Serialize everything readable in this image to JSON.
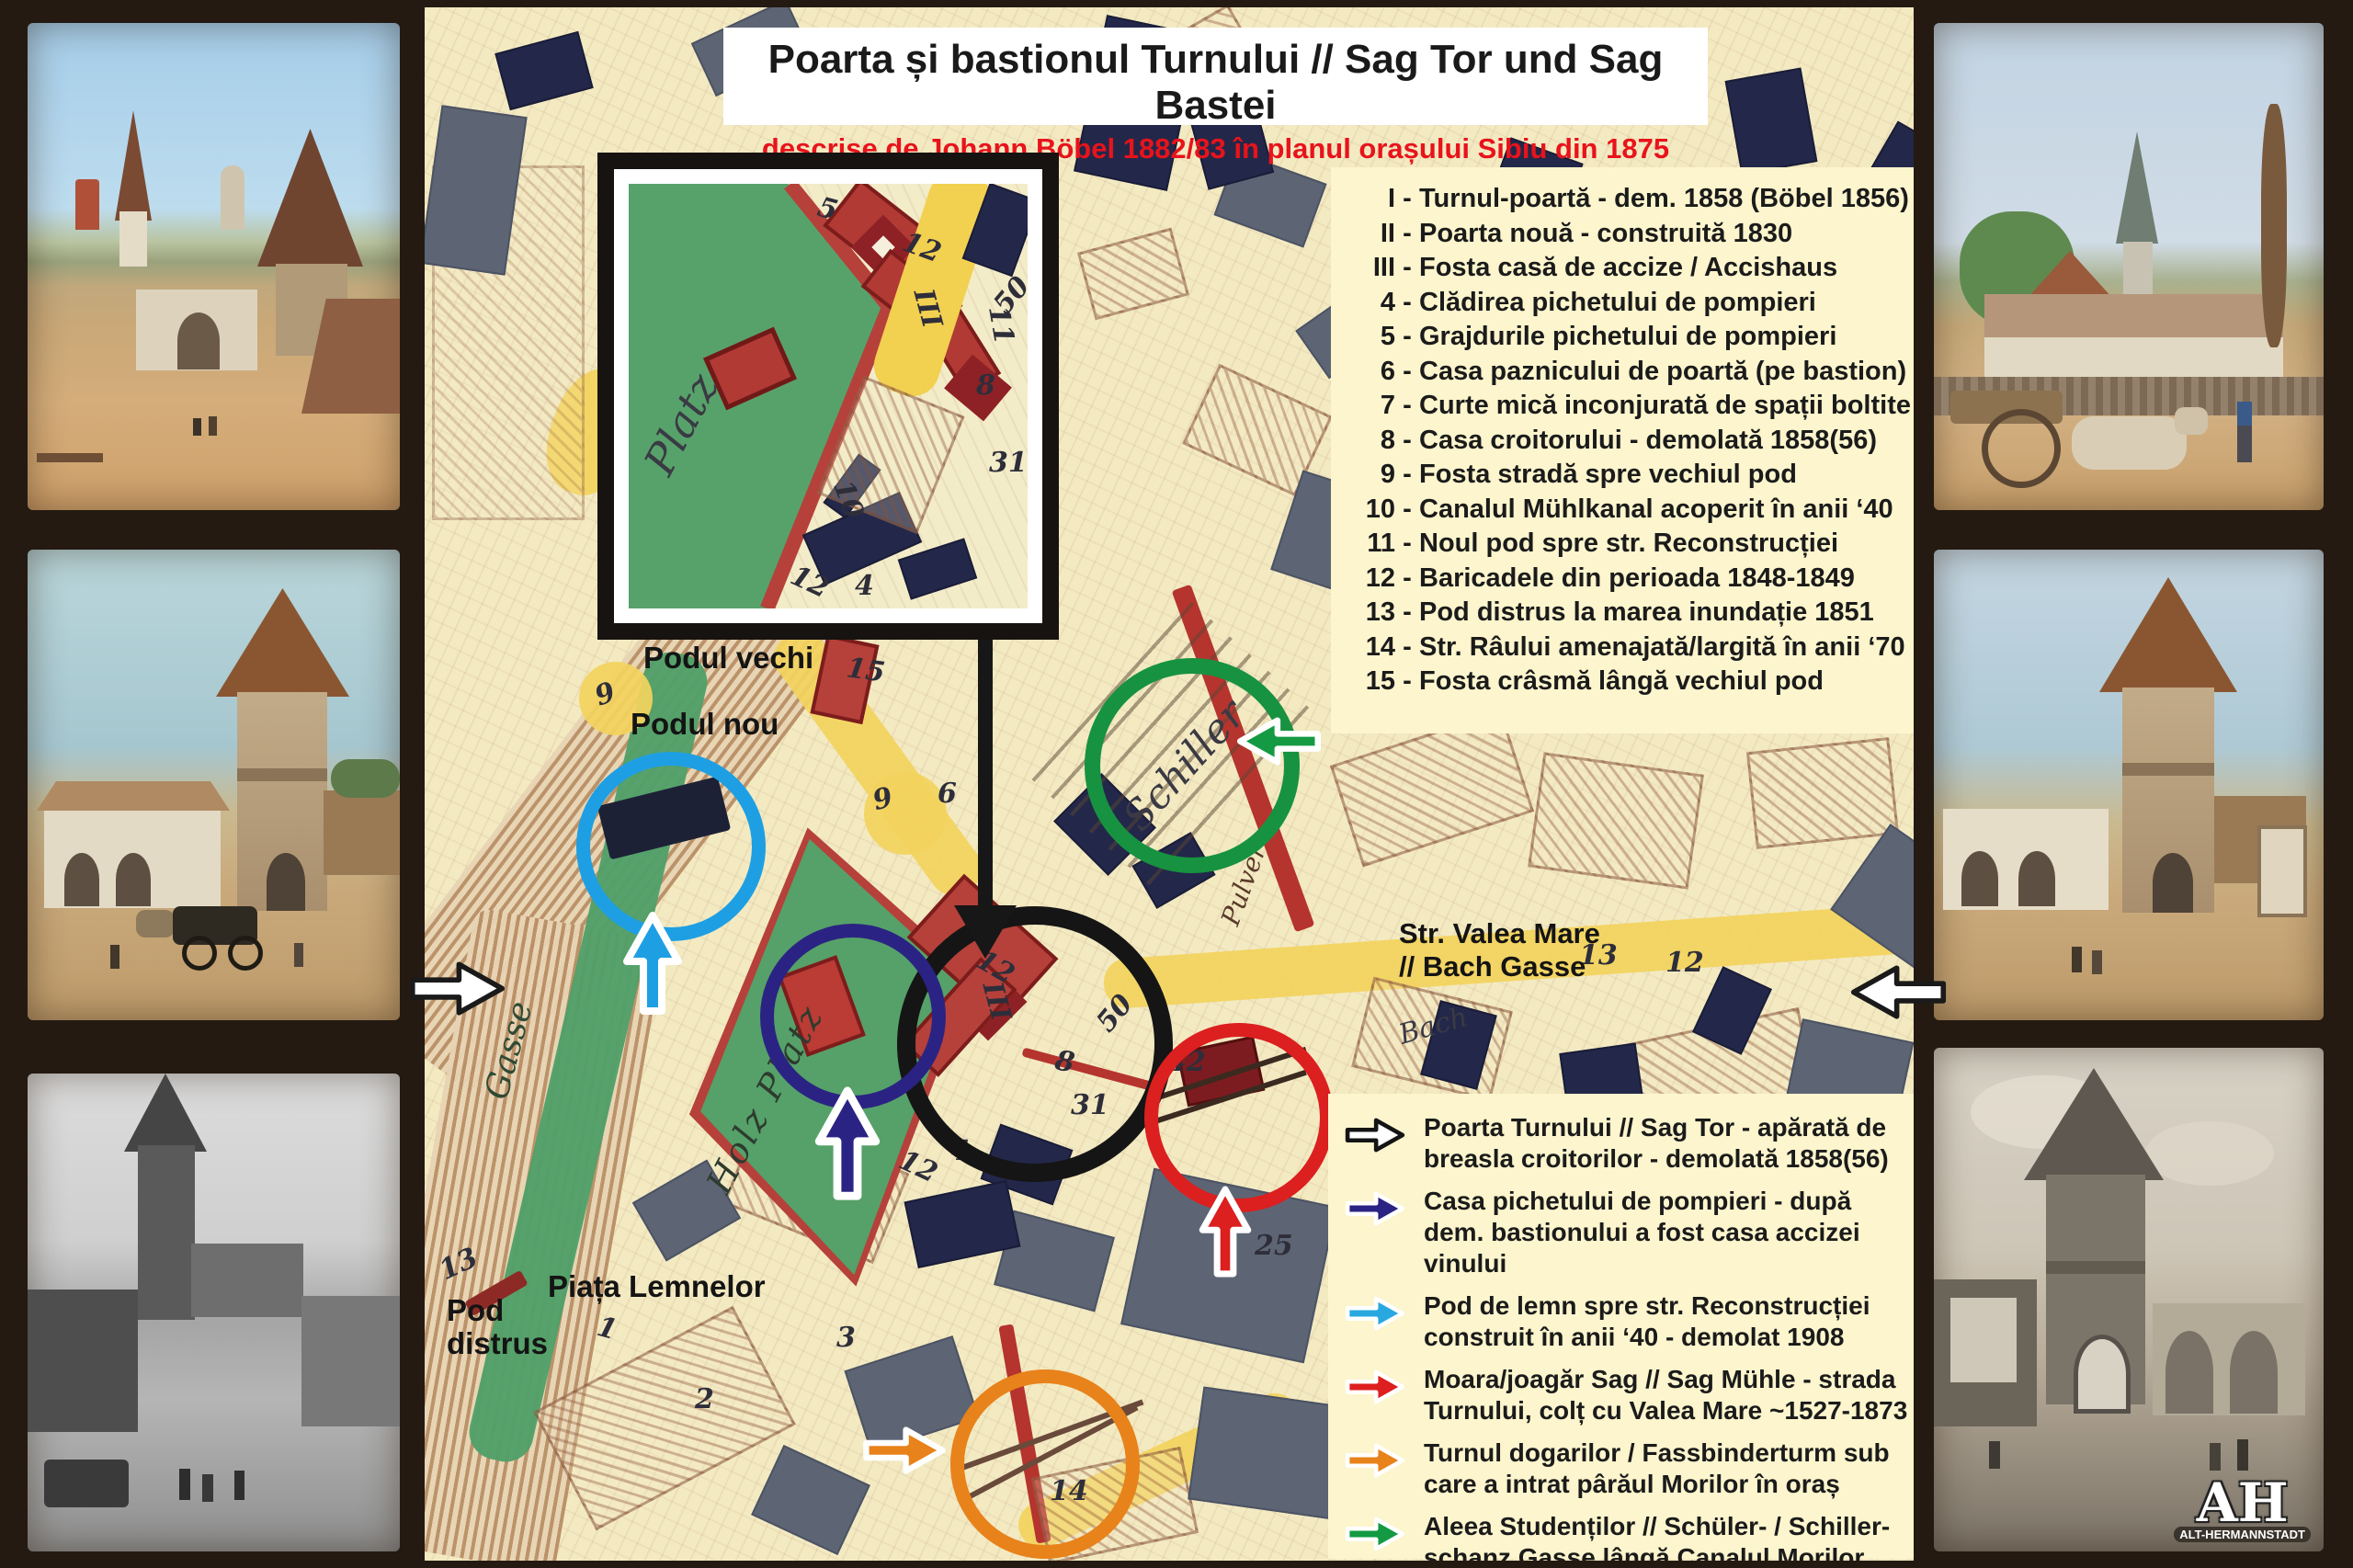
{
  "title": {
    "line1": "Poarta și bastionul Turnului // Sag Tor und Sag Bastei",
    "line2": "descrise de Johann Böbel 1882/83 în planul orașului Sibiu din 1875"
  },
  "legend": {
    "sep": "-",
    "items": [
      {
        "num": "I",
        "text": "Turnul-poartă - dem. 1858 (Böbel 1856)"
      },
      {
        "num": "II",
        "text": "Poarta nouă - construită 1830"
      },
      {
        "num": "III",
        "text": "Fosta casă de accize / Accishaus"
      },
      {
        "num": "4",
        "text": "Clădirea pichetului de pompieri"
      },
      {
        "num": "5",
        "text": "Grajdurile pichetului de pompieri"
      },
      {
        "num": "6",
        "text": "Casa paznicului de poartă (pe bastion)"
      },
      {
        "num": "7",
        "text": "Curte mică inconjurată de spații boltite"
      },
      {
        "num": "8",
        "text": "Casa croitorului - demolată 1858(56)"
      },
      {
        "num": "9",
        "text": "Fosta stradă spre vechiul pod"
      },
      {
        "num": "10",
        "text": "Canalul Mühlkanal acoperit în anii ‘40"
      },
      {
        "num": "11",
        "text": "Noul pod spre str. Reconstrucției"
      },
      {
        "num": "12",
        "text": "Baricadele din perioada 1848-1849"
      },
      {
        "num": "13",
        "text": "Pod distrus la marea inundație 1851"
      },
      {
        "num": "14",
        "text": "Str. Râului amenajată/largită în anii ‘70"
      },
      {
        "num": "15",
        "text": "Fosta crâsmă lângă vechiul pod"
      }
    ]
  },
  "arrow_legend": {
    "items": [
      {
        "color": "#ffffff",
        "outline": "#141414",
        "text": "Poarta Turnului // Sag Tor - apărată de breasla croitorilor - demolată 1858(56)"
      },
      {
        "color": "#2b2383",
        "outline": "#ffffff",
        "text": "Casa pichetului de pompieri - după dem. bastionului a fost casa accizei vinului"
      },
      {
        "color": "#29a8e0",
        "outline": "#ffffff",
        "text": "Pod de lemn spre str. Reconstrucției construit în anii ‘40 - demolat 1908"
      },
      {
        "color": "#dd1f1f",
        "outline": "#ffffff",
        "text": "Moara/joagăr Sag // Sag Mühle - strada Turnului, colț cu Valea Mare ~1527-1873"
      },
      {
        "color": "#e8821a",
        "outline": "#ffffff",
        "text": "Turnul dogarilor / Fassbinderturm sub care a intrat pârăul Morilor în oraș"
      },
      {
        "color": "#149a43",
        "outline": "#ffffff",
        "text": "Aleea Studenților // Schüler- / Schiller-schanz Gasse lângă Canalul Morilor"
      }
    ]
  },
  "map_labels": {
    "podul_vechi": "Podul vechi",
    "podul_nou": "Podul nou",
    "valea_mare_1": "Str. Valea Mare",
    "valea_mare_2": "// Bach Gasse",
    "piata": "Piața Lemnelor",
    "pod_1": "Pod",
    "pod_2": "distrus"
  },
  "script_labels": {
    "schiller": "Schiller",
    "gasse_left": "Gasse",
    "gasse_top": "Gasse",
    "bach": "Bach",
    "pulver": "Pulver",
    "holz_platz": "Holz Platz",
    "platz_inset": "Platz"
  },
  "map_numbers": [
    "9",
    "15",
    "9",
    "6",
    "12",
    "III",
    "8",
    "31",
    "50",
    "42",
    "25",
    "12",
    "4",
    "14",
    "13",
    "1",
    "2",
    "3",
    "13",
    "12"
  ],
  "inset_numbers": [
    "5",
    "12",
    "III",
    "11",
    "50",
    "8",
    "31",
    "10",
    "12",
    "4"
  ],
  "watermark": {
    "initials": "AH",
    "subtitle": "ALT-HERMANNSTADT"
  },
  "images": {
    "left": [
      "painting-sag-gate-and-city-wall",
      "painting-sag-tower-street-scene",
      "photo-bw-street-with-church-tower"
    ],
    "right": [
      "painting-city-panorama-with-ox-cart",
      "painting-sag-tower-gate",
      "engraving-bw-sag-tower-gate"
    ]
  },
  "colors": {
    "frame": "#241a12",
    "map_cream": "#f3eac2",
    "legend_bg": "#fcf5cd",
    "title_red": "#e8131b",
    "circle_black": "#151515",
    "circle_blue": "#1e9fe3",
    "circle_navy": "#2b2383",
    "circle_green": "#179240",
    "circle_red": "#dc1f1f",
    "circle_orange": "#e8821a"
  }
}
